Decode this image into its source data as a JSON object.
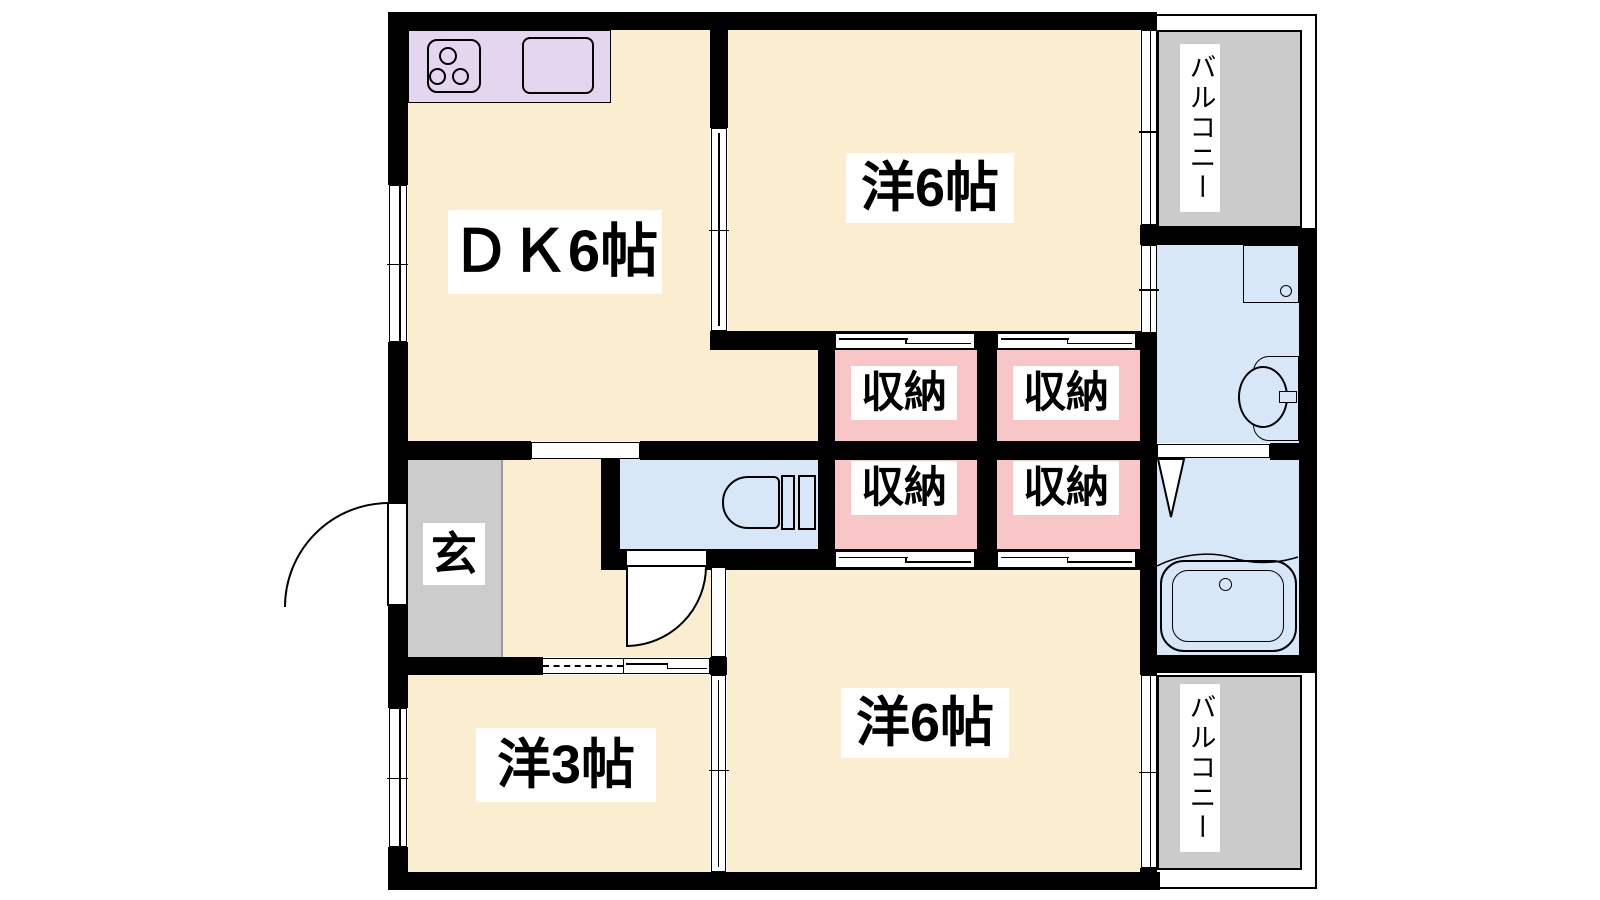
{
  "floorplan": {
    "type": "japanese-apartment-2dk",
    "rooms": {
      "dk": {
        "label": "ＤＫ6帖",
        "size_tatami": 6
      },
      "bedroom_top": {
        "label": "洋6帖",
        "size_tatami": 6
      },
      "bedroom_bottom": {
        "label": "洋6帖",
        "size_tatami": 6
      },
      "bedroom_small": {
        "label": "洋3帖",
        "size_tatami": 3
      },
      "entrance": {
        "label": "玄"
      },
      "balcony_top": {
        "label": "バルコニー"
      },
      "balcony_bottom": {
        "label": "バルコニー"
      },
      "closets": {
        "top_left": {
          "label": "収納"
        },
        "top_right": {
          "label": "収納"
        },
        "bottom_left": {
          "label": "収納"
        },
        "bottom_right": {
          "label": "収納"
        }
      }
    },
    "colors": {
      "room_cream": "#FBEED0",
      "closet_pink": "#F8C6C6",
      "water_blue": "#D8E7F8",
      "balcony_gray": "#CBCBCB",
      "entrance_gray": "#CCCCCC",
      "kitchen_lavender": "#E3D6EE",
      "wall_black": "#000000",
      "background": "#FFFFFF"
    },
    "icons": [
      "stove-icon",
      "kitchen-sink-icon",
      "toilet-icon",
      "bathtub-icon",
      "washbasin-icon",
      "washer-pan-icon",
      "door-swing-arc-icon",
      "sliding-door-icon",
      "window-icon",
      "folding-door-triangle-icon"
    ]
  }
}
